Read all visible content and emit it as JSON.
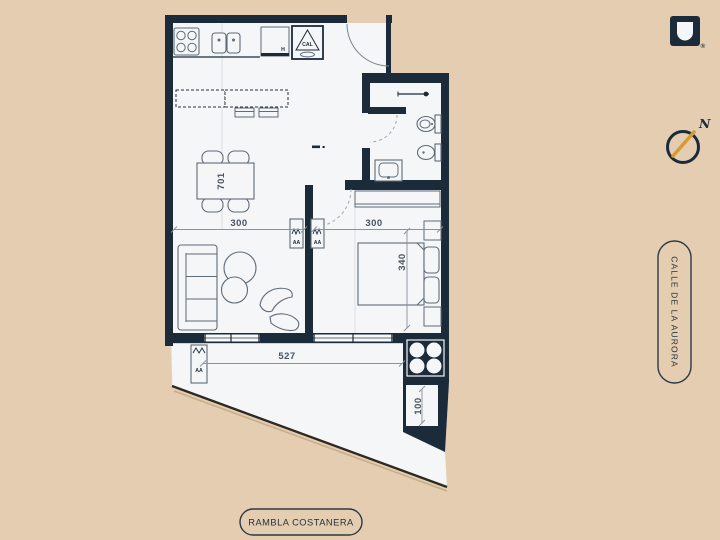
{
  "colors": {
    "background": "#e4cdb0",
    "wall": "#1c2b3a",
    "floor": "#f4f6f7",
    "accent_orange": "#d99a33"
  },
  "plan": {
    "labels": {
      "unit_number": "701",
      "living_width": "300",
      "bedroom_width": "300",
      "bedroom_depth": "340",
      "terrace_width": "527",
      "terrace_depth": "100",
      "oven_label": "H",
      "heater_label": "CAL",
      "ac_markers": [
        "AA",
        "AA",
        "AA"
      ]
    }
  },
  "compass": {
    "north_label": "N"
  },
  "branding": {
    "registered_mark": "®"
  },
  "streets": {
    "right_street": "CALLE DE LA AURORA",
    "bottom_street": "RAMBLA COSTANERA"
  }
}
